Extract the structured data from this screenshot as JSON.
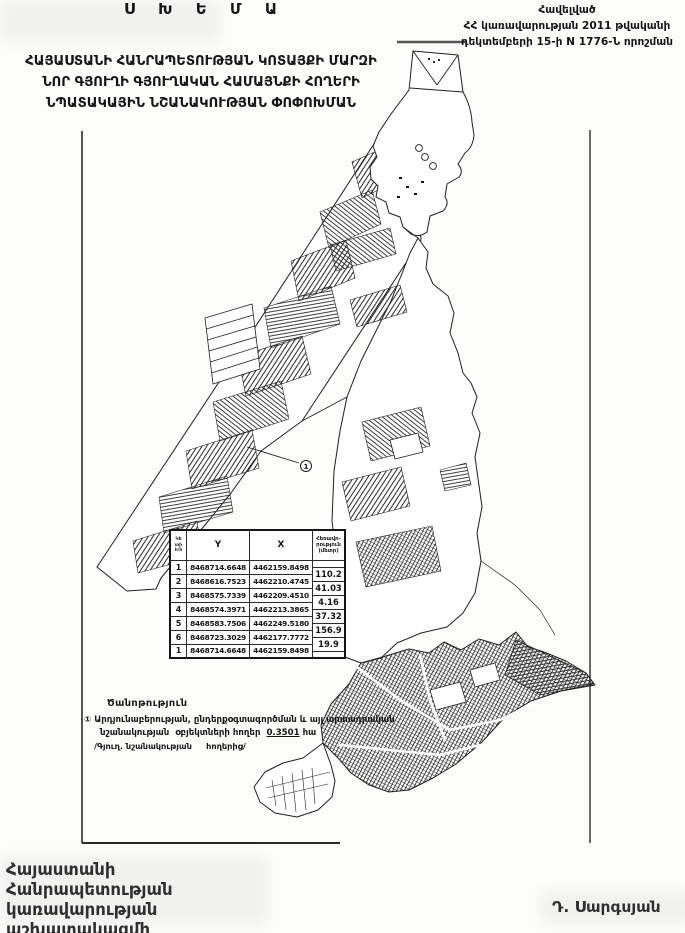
{
  "page": {
    "scheme_title": "Ս Խ Ե Մ Ա",
    "subtitle_lines": [
      "ՀԱՅԱՍՏԱՆԻ ՀԱՆՐԱՊԵՏՈՒԹՅԱՆ ԿՈՏԱՅՔԻ ՄԱՐԶԻ",
      "ՆՈՐ ԳՅՈՒՂԻ ԳՅՈՒՂԱԿԱՆ ՀԱՄԱՅՆՔԻ ՀՈՂԵՐԻ",
      "ՆՊԱՏԱԿԱՅԻՆ ՆՇԱՆԱԿՈՒԹՅԱՆ ՓՈՓՈԽՄԱՆ"
    ]
  },
  "annex": {
    "lines": [
      "Հավելված",
      "ՀՀ կառավարության 2011 թվականի",
      "դեկտեմբերի 15-ի N 1776-Ն որոշման"
    ]
  },
  "table": {
    "headers": {
      "num_lines": [
        "Կե",
        "տի",
        "հ/հ"
      ],
      "y": "Y",
      "x": "X",
      "dist_lines": [
        "Հեռավո-",
        "րություն",
        "(մետր)"
      ]
    },
    "rows": [
      {
        "n": "1",
        "y": "8468714.6648",
        "x": "4462159.8498"
      },
      {
        "n": "2",
        "y": "8468616.7523",
        "x": "4462210.4745"
      },
      {
        "n": "3",
        "y": "8468575.7339",
        "x": "4462209.4510"
      },
      {
        "n": "4",
        "y": "8468574.3971",
        "x": "4462213.3865"
      },
      {
        "n": "5",
        "y": "8468583.7506",
        "x": "4462249.5180"
      },
      {
        "n": "6",
        "y": "8468723.3029",
        "x": "4462177.7772"
      },
      {
        "n": "1",
        "y": "8468714.6648",
        "x": "4462159.8498"
      }
    ],
    "distances": [
      "110.2",
      "41.03",
      "4.16",
      "37.32",
      "156.9",
      "19.9"
    ]
  },
  "map": {
    "callout_label": "1"
  },
  "notes": {
    "heading": "Ծանոթություն",
    "marker": "①",
    "line1": " Արդյունաբերության, ընդերքօգտագործման և այլ արտադրական",
    "line2": "նշանակության  օբյեկտների հողեր  ",
    "area": "0.3501",
    "unit": " հա",
    "line3": "/Գյուղ. նշանակության     հողերից/"
  },
  "signature": {
    "left_lines": [
      "Հայաստանի Հանրապետության",
      "կառավարության աշխատակազմի",
      "ղեկավար"
    ],
    "right": "Դ. Սարգսյան"
  },
  "colors": {
    "ink": "#161616",
    "frame_line": "#2a2a2a",
    "paper": "#fcfcfb"
  }
}
